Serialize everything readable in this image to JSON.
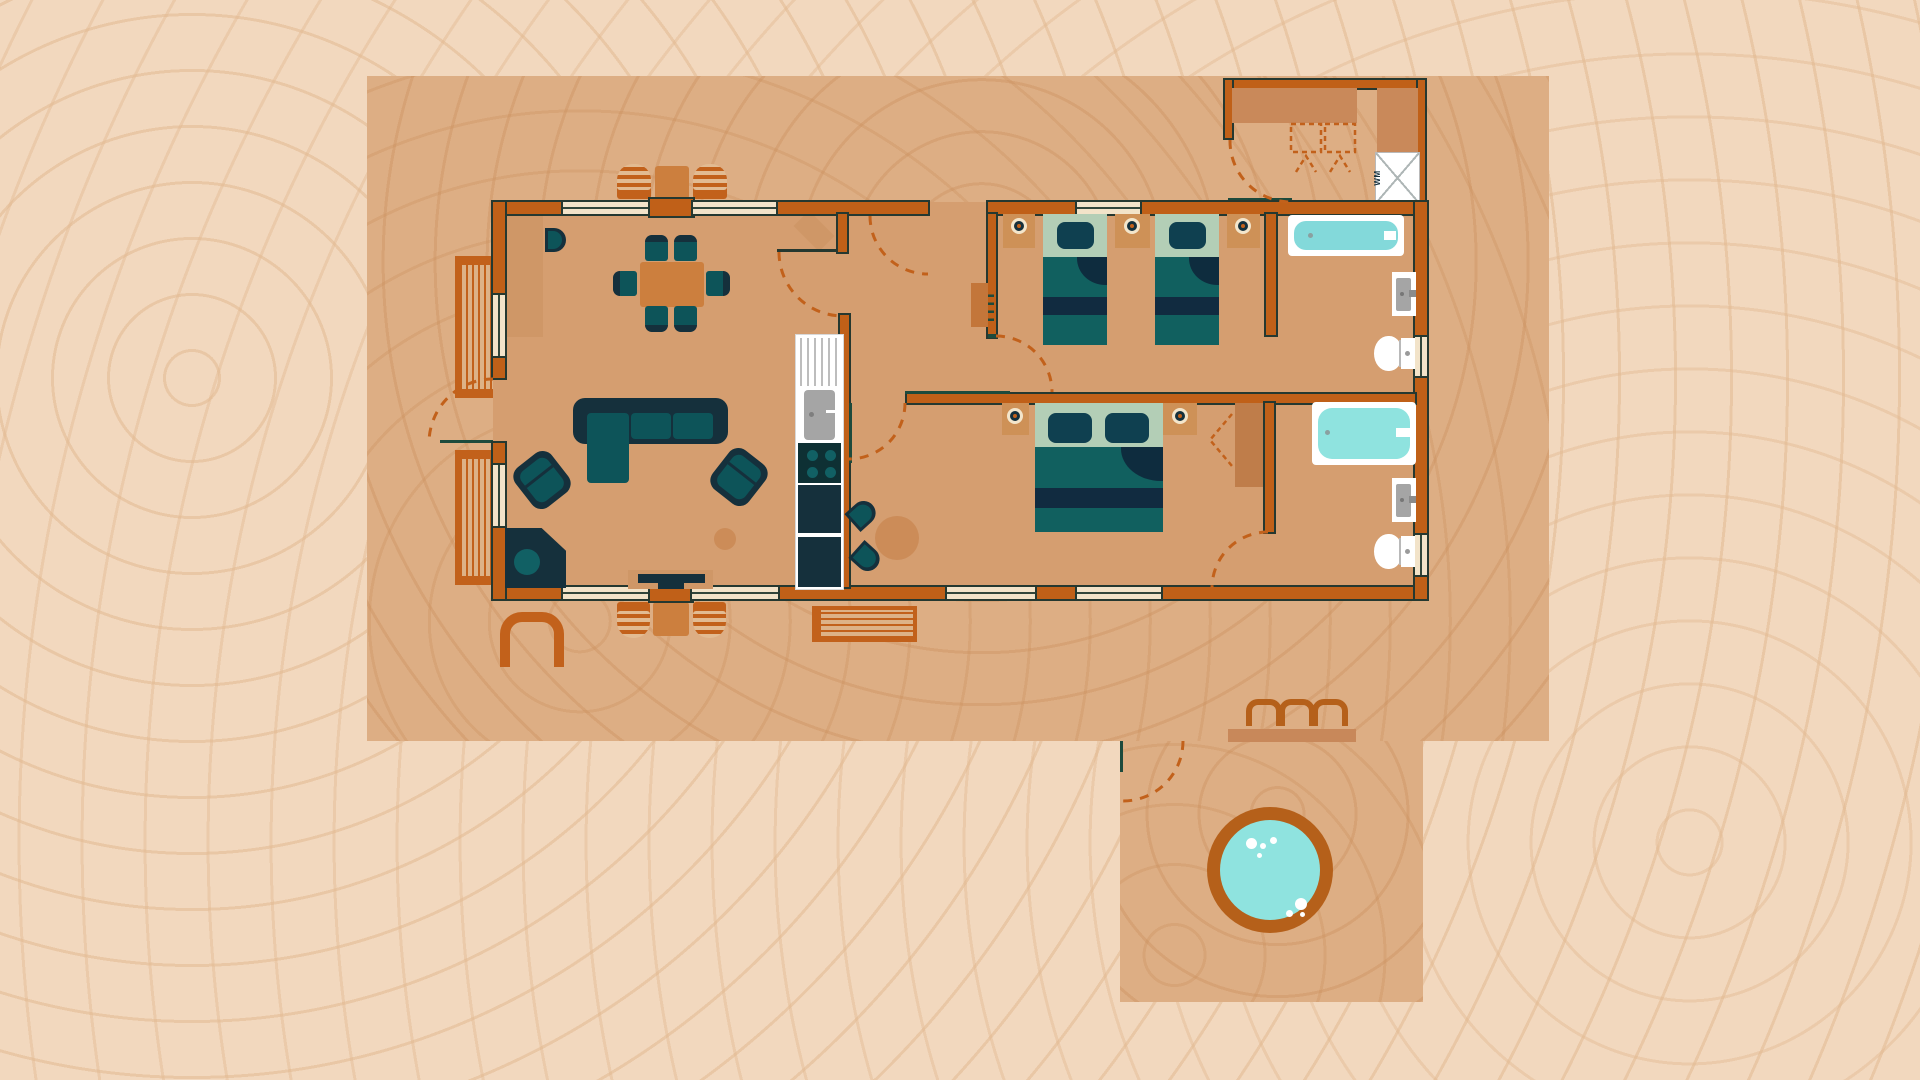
{
  "title": "Lodge floor plan illustration (top-down)",
  "labels": {
    "washing_machine": "WM"
  },
  "colors": {
    "bg": "#f2d8be",
    "deck": "#ddae84",
    "floor": "#d59e70",
    "rug": "#cf9767",
    "wall": "#c06018",
    "line": "#253830",
    "windowFill": "#f2e3c9",
    "accentGreen": "#1d4a3c",
    "dash": "#c2611b",
    "orange": "#c2611b",
    "hotTubRing": "#b5601a",
    "navy": "#15303c",
    "teal": "#0d5459",
    "tealBright": "#116064",
    "sage": "#b3ceb6",
    "pillow": "#0f4050",
    "blanket": "#11605f",
    "stripeDark": "#112b40",
    "bathWater": "#83d9da",
    "bathWater2": "#8fe3df",
    "hotTubWater": "#8fe3df",
    "tanTable": "#cc7f3e",
    "tanRound": "#cc8c58",
    "nightstand": "#ce9157",
    "wardrobe": "#bf7d4a",
    "radiator": "#c3763a",
    "shelf": "#c9895a",
    "stepBar": "#c8885a"
  },
  "rooms": {
    "living_room": {
      "furniture": [
        "corner-sofa",
        "armchair-left",
        "armchair-right",
        "corner-stove",
        "tv-unit",
        "side-table",
        "dining-table",
        "dining-chairs-x6",
        "high-chair",
        "entry-rug",
        "door-mat"
      ]
    },
    "kitchen": {
      "furniture": [
        "drainer-counter",
        "sink-unit",
        "hob-4-burners",
        "fridge",
        "base-unit",
        "breakfast-table",
        "breakfast-chairs-x2"
      ]
    },
    "hallway": {
      "furniture": [
        "radiator"
      ]
    },
    "bedroom_twin": {
      "furniture": [
        "single-bed-x2",
        "nightstand-x3",
        "lamp-x3"
      ]
    },
    "bedroom_double": {
      "furniture": [
        "double-bed",
        "nightstand-x2",
        "lamp-x2",
        "wardrobe"
      ]
    },
    "bathroom_1": {
      "furniture": [
        "bathtub",
        "wash-basin",
        "toilet"
      ]
    },
    "bathroom_2": {
      "furniture": [
        "bathtub-large",
        "wash-basin",
        "toilet"
      ]
    },
    "utility_store": {
      "furniture": [
        "shelf",
        "cabinet",
        "washing-machine",
        "folded-chairs-dashed-x2"
      ]
    }
  },
  "outdoor": {
    "deck": {
      "furniture": [
        "bench-left-x2",
        "bench-bottom",
        "outdoor-table-set-top",
        "outdoor-table-set-bottom",
        "pet-bed-arch",
        "planter-pots-x3",
        "step-edge",
        "hot-tub"
      ]
    },
    "door_swings_dashed_arcs": 8
  }
}
